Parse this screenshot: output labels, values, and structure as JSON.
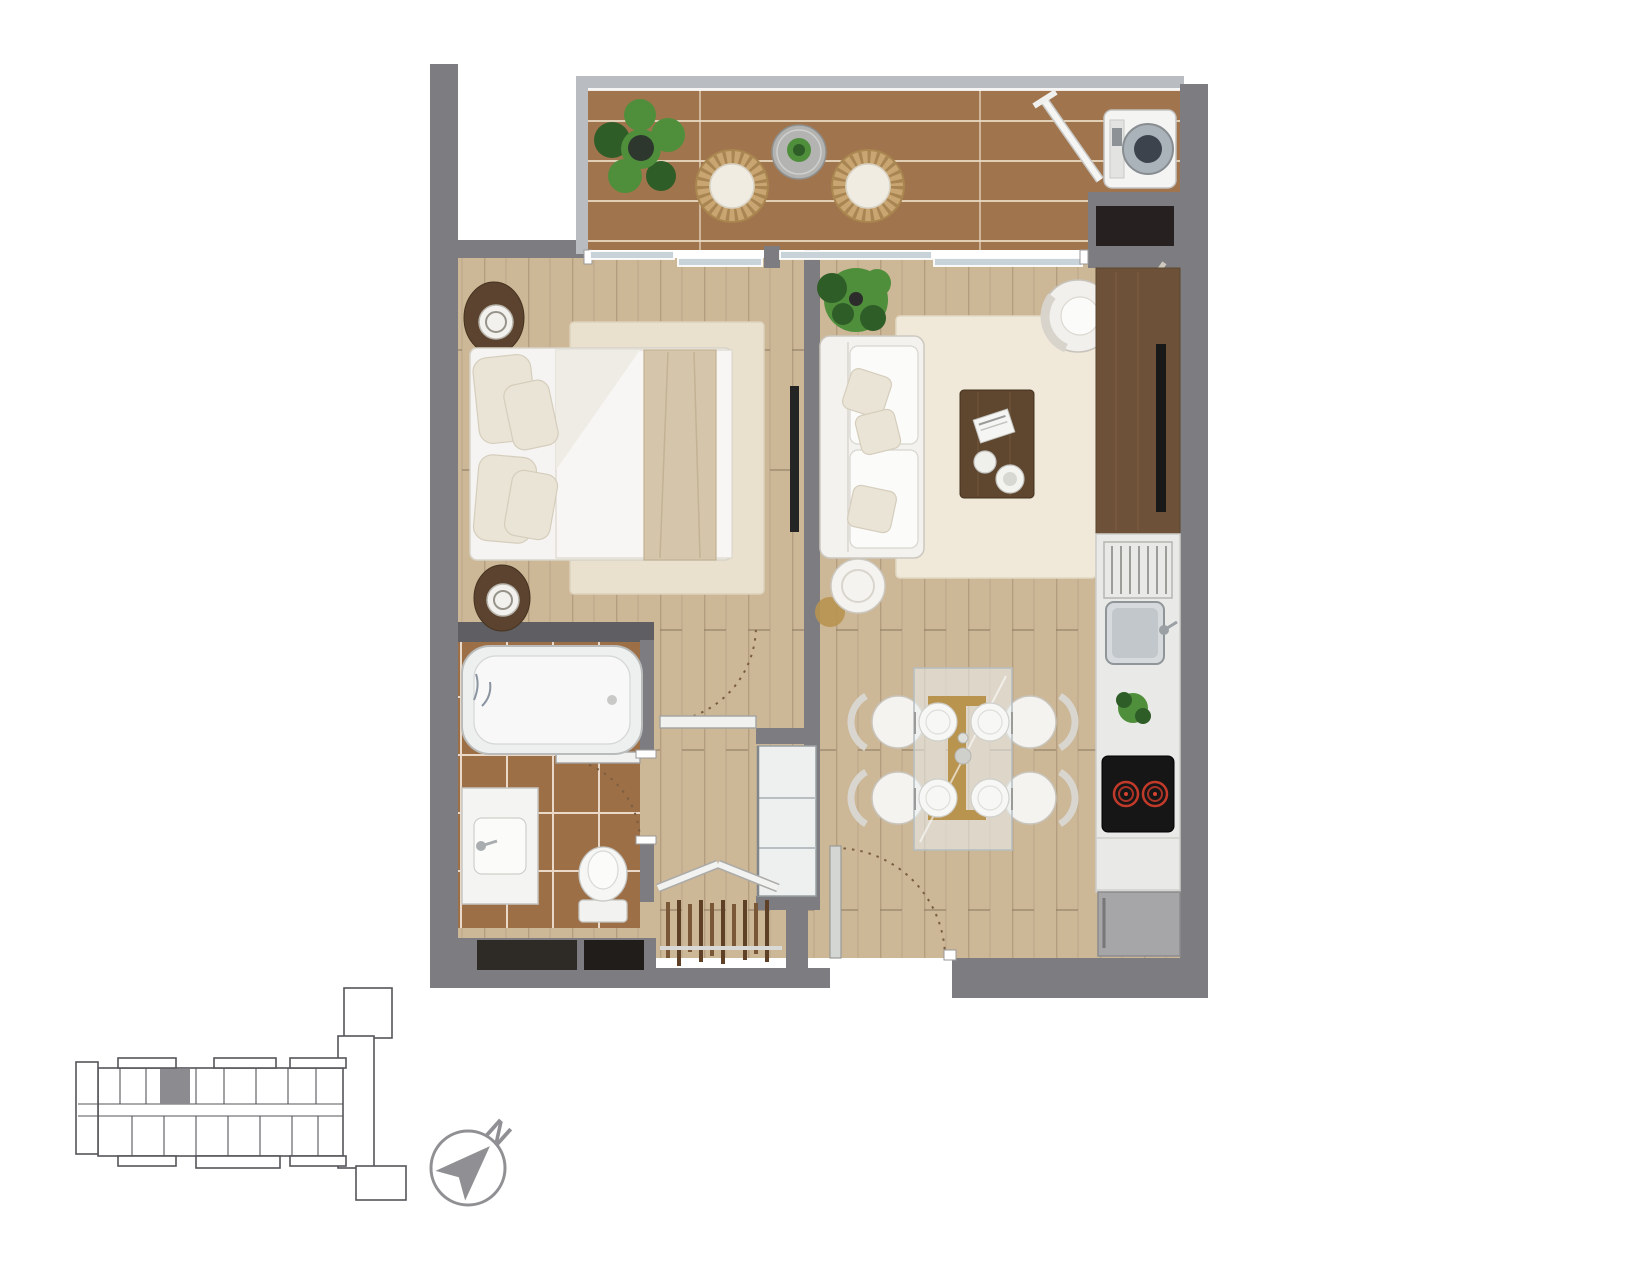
{
  "compass": {
    "north_label": "N"
  },
  "palette": {
    "wall": "#7d7d81",
    "wall_dark": "#5e5e63",
    "railing": "#b9bdc1",
    "glass_blue": "#c7d3d8",
    "room_floor": "#ccb797",
    "room_plank_line": "#b49e7f",
    "room_seam": "#8a7960",
    "balcony_floor": "#a0744c",
    "balcony_line": "#eadbc4",
    "bathroom_floor": "#9c6f47",
    "grout": "#ead9c8",
    "niche_dark": "#262120",
    "furniture_white": "#f4f3f0",
    "furniture_stroke": "#c9c5bd",
    "wood_dark": "#5f462f",
    "wood_mid": "#6d5138",
    "counter": "#e9e9e7",
    "appliance_dark": "#161616",
    "burner_red": "#c23a2a",
    "fridge_gray": "#a6a6a8",
    "plant_green": "#4f8f3c",
    "plant_dark": "#2f5d28",
    "gold": "#b8944f",
    "arc_dash": "#7b5e41",
    "keyplan_line": "#55555a",
    "keyplan_fill": "#8c8c90",
    "compass_gray": "#909094"
  },
  "plan": {
    "rooms": [
      {
        "name": "balcony",
        "furniture": [
          "potted-fern",
          "wicker-chair",
          "wicker-chair",
          "round-side-table",
          "washing-machine",
          "drying-pole",
          "storage-niche"
        ]
      },
      {
        "name": "bedroom",
        "furniture": [
          "double-bed",
          "pillows",
          "nightstand-with-lamp",
          "nightstand-with-lamp",
          "area-rug",
          "wall-tv"
        ]
      },
      {
        "name": "living-room",
        "furniture": [
          "sofa",
          "throw-pillows",
          "potted-plant",
          "floor-lamp",
          "area-rug",
          "coffee-table",
          "lounge-chair",
          "guitar",
          "media-console"
        ]
      },
      {
        "name": "dining-area",
        "furniture": [
          "glass-dining-table",
          "dining-chair",
          "dining-chair",
          "dining-chair",
          "dining-chair",
          "place-settings"
        ]
      },
      {
        "name": "kitchen",
        "furniture": [
          "countertop",
          "dish-rack",
          "sink",
          "herb-plant",
          "two-burner-cooktop",
          "base-cabinet",
          "refrigerator"
        ]
      },
      {
        "name": "bathroom",
        "furniture": [
          "bathtub",
          "vanity-sink",
          "toilet"
        ]
      },
      {
        "name": "entry-hall",
        "furniture": [
          "entry-door",
          "shelved-closet",
          "clothes-rack",
          "service-shafts"
        ]
      }
    ],
    "doors": [
      "balcony-sliding-door-bedroom",
      "balcony-sliding-door-living",
      "bedroom-door",
      "bathroom-door",
      "entry-door"
    ]
  },
  "key_plan": {
    "highlighted_unit": true
  }
}
